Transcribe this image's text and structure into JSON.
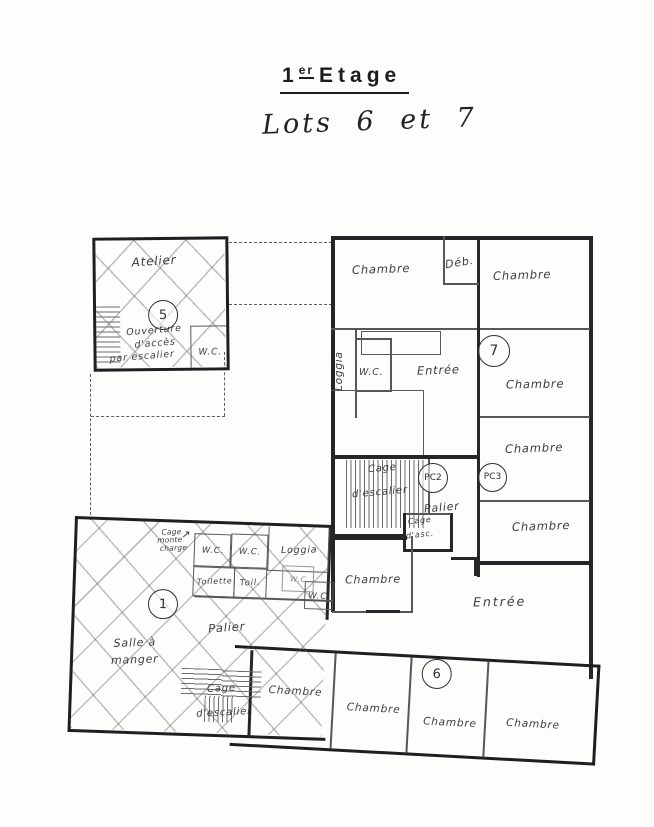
{
  "page": {
    "title_num": "1",
    "title_sup": "er",
    "title_word": "Etage",
    "subtitle": "Lots 6 et 7"
  },
  "lot5": {
    "name": "Atelier",
    "badge": "5",
    "note1": "Ouverture",
    "note2": "d'accès",
    "note3": "par escalier",
    "wc": "W.C."
  },
  "lot7": {
    "chambre_nw": "Chambre",
    "deb": "Déb.",
    "chambre_ne": "Chambre",
    "loggia": "Loggia",
    "wc": "W.C.",
    "entree": "Entrée",
    "badge": "7",
    "chambre_e1": "Chambre",
    "chambre_e2": "Chambre",
    "chambre_e3": "Chambre"
  },
  "core": {
    "cage1": "Cage",
    "cage2": "d'escalier",
    "pc2": "PC2",
    "pc3": "PC3",
    "palier": "Palier",
    "asc1": "Cage",
    "asc2": "d'asc."
  },
  "lot1": {
    "mc1": "Cage",
    "mc2": "monte",
    "mc3": "charge",
    "arrow_icon": "↗",
    "wc1": "W.C.",
    "wc2": "W.C.",
    "loggia": "Loggia",
    "toilette": "Toilette",
    "toil": "Toil.",
    "wc3": "W.C",
    "wc4": "W.C.",
    "badge": "1",
    "salle1": "Salle à",
    "salle2": "manger",
    "palier": "Palier",
    "cage1": "Cage",
    "cage2": "d'escalier"
  },
  "lot6": {
    "chambre_w": "Chambre",
    "entree": "Entrée",
    "badge": "6",
    "chambre_1": "Chambre",
    "chambre_2": "Chambre",
    "chambre_3": "Chambre",
    "chambre_4": "Chambre"
  }
}
